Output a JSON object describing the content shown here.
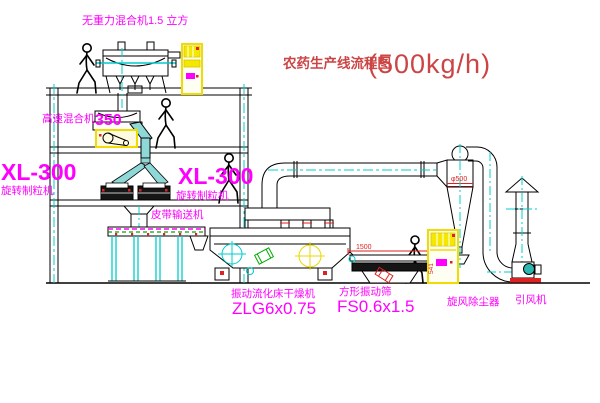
{
  "title": {
    "name": "农药生产线流程图",
    "capacity": "(500kg/h)"
  },
  "labels": {
    "no_gravity_mixer": "无重力混合机1.5 立方",
    "high_speed_mixer_name": "高速混合机",
    "high_speed_mixer_model": "350",
    "granulator_left_model": "XL-300",
    "granulator_left_name": "旋转制粒机",
    "granulator_right_model": "XL-300",
    "granulator_right_name": "旋转制粒机",
    "belt_conveyor": "皮带输送机",
    "dryer_name": "振动流化床干燥机",
    "dryer_model": "ZLG6x0.75",
    "screen_name": "方形振动筛",
    "screen_model": "FS0.6x1.5",
    "cyclone": "旋风除尘器",
    "fan": "引风机"
  },
  "dimensions": {
    "cyclone_diameter": "φ500",
    "screen_length": "1500",
    "screen_height": "541"
  },
  "colors": {
    "line": "#000000",
    "centerline": "#00cccc",
    "label": "#ff00ff",
    "title_red": "#cc4444",
    "dimension_red": "#dd2222",
    "cabinet_yellow": "#f0dc00",
    "chute_teal": "#8fd8d8",
    "belt_green": "#00aa00"
  }
}
